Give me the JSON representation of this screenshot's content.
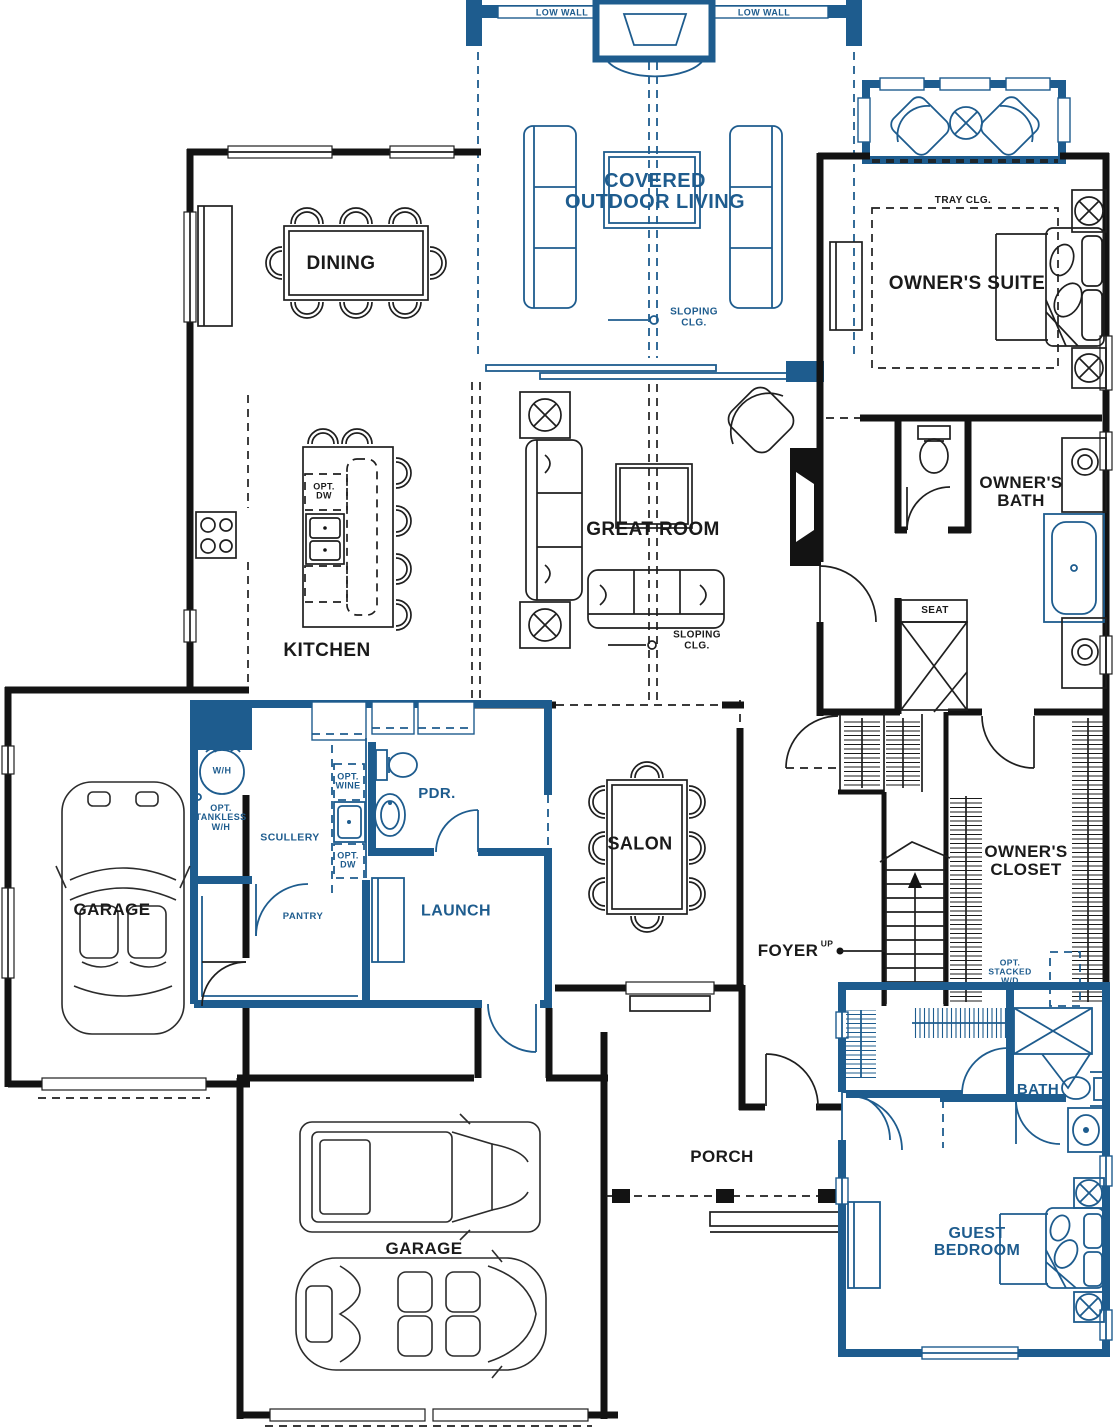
{
  "colors": {
    "wall_black": "#131313",
    "accent_blue": "#1e5c8e",
    "background": "#ffffff"
  },
  "labels": {
    "low_wall_left": "LOW WALL",
    "low_wall_right": "LOW WALL",
    "covered_outdoor_living": "COVERED OUTDOOR LIVING",
    "sloping_clg_outdoor": "SLOPING CLG.",
    "sloping_clg_great": "SLOPING CLG.",
    "tray_clg": "TRAY CLG.",
    "owners_suite": "OWNER'S SUITE",
    "dining": "DINING",
    "kitchen": "KITCHEN",
    "opt_dw_island": "OPT. DW",
    "great_room": "GREAT ROOM",
    "owners_bath": "OWNER'S BATH",
    "seat": "SEAT",
    "wh": "W/H",
    "opt_tankless_wh": "OPT. TANKLESS W/H",
    "scullery": "SCULLERY",
    "opt_wine": "OPT. WINE",
    "opt_dw_scullery": "OPT. DW",
    "pdr": "PDR.",
    "pantry": "PANTRY",
    "launch": "LAUNCH",
    "salon": "SALON",
    "foyer": "FOYER",
    "up": "UP",
    "owners_closet": "OWNER'S CLOSET",
    "opt_stacked_wd": "OPT. STACKED W/D",
    "garage_left": "GARAGE",
    "garage_bottom": "GARAGE",
    "porch": "PORCH",
    "bath_guest": "BATH",
    "guest_bedroom": "GUEST BEDROOM"
  }
}
